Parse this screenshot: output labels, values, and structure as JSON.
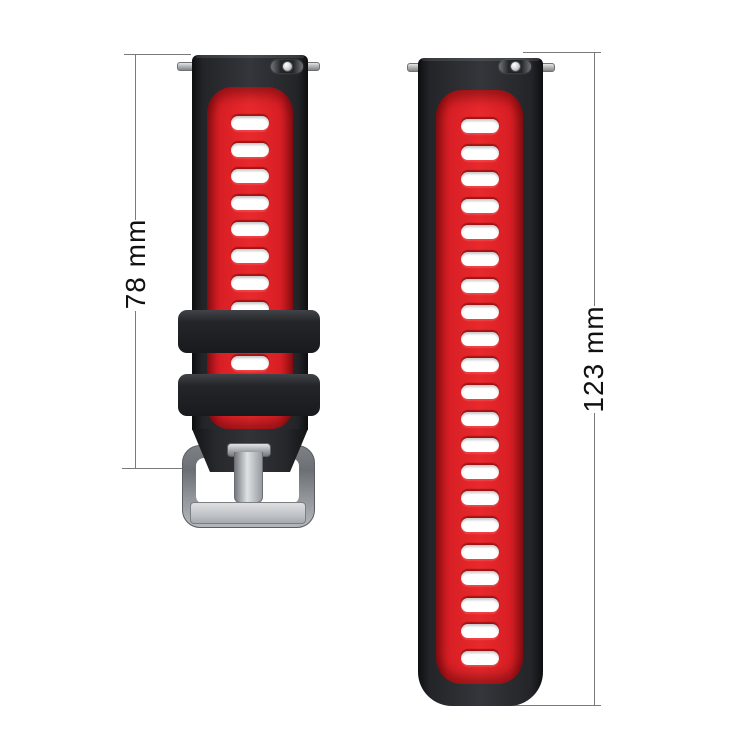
{
  "annotations": {
    "left_dimension": {
      "label": "78 mm"
    },
    "right_dimension": {
      "label": "123 mm"
    },
    "line_color": "#7a7a7a",
    "text_color": "#111111"
  },
  "product": {
    "description": "two-tone silicone watch band, two pieces, with silver buckle",
    "colors": {
      "outer_black": "#232428",
      "inner_red": "#e02127",
      "slot_white": "#ffffff",
      "buckle_silver": "#b4b8bc"
    },
    "left_strap": {
      "slots_upper": 8,
      "slots_between_keepers": 1,
      "keeper_count": 2,
      "has_buckle": true
    },
    "right_strap": {
      "slots": 21
    }
  }
}
